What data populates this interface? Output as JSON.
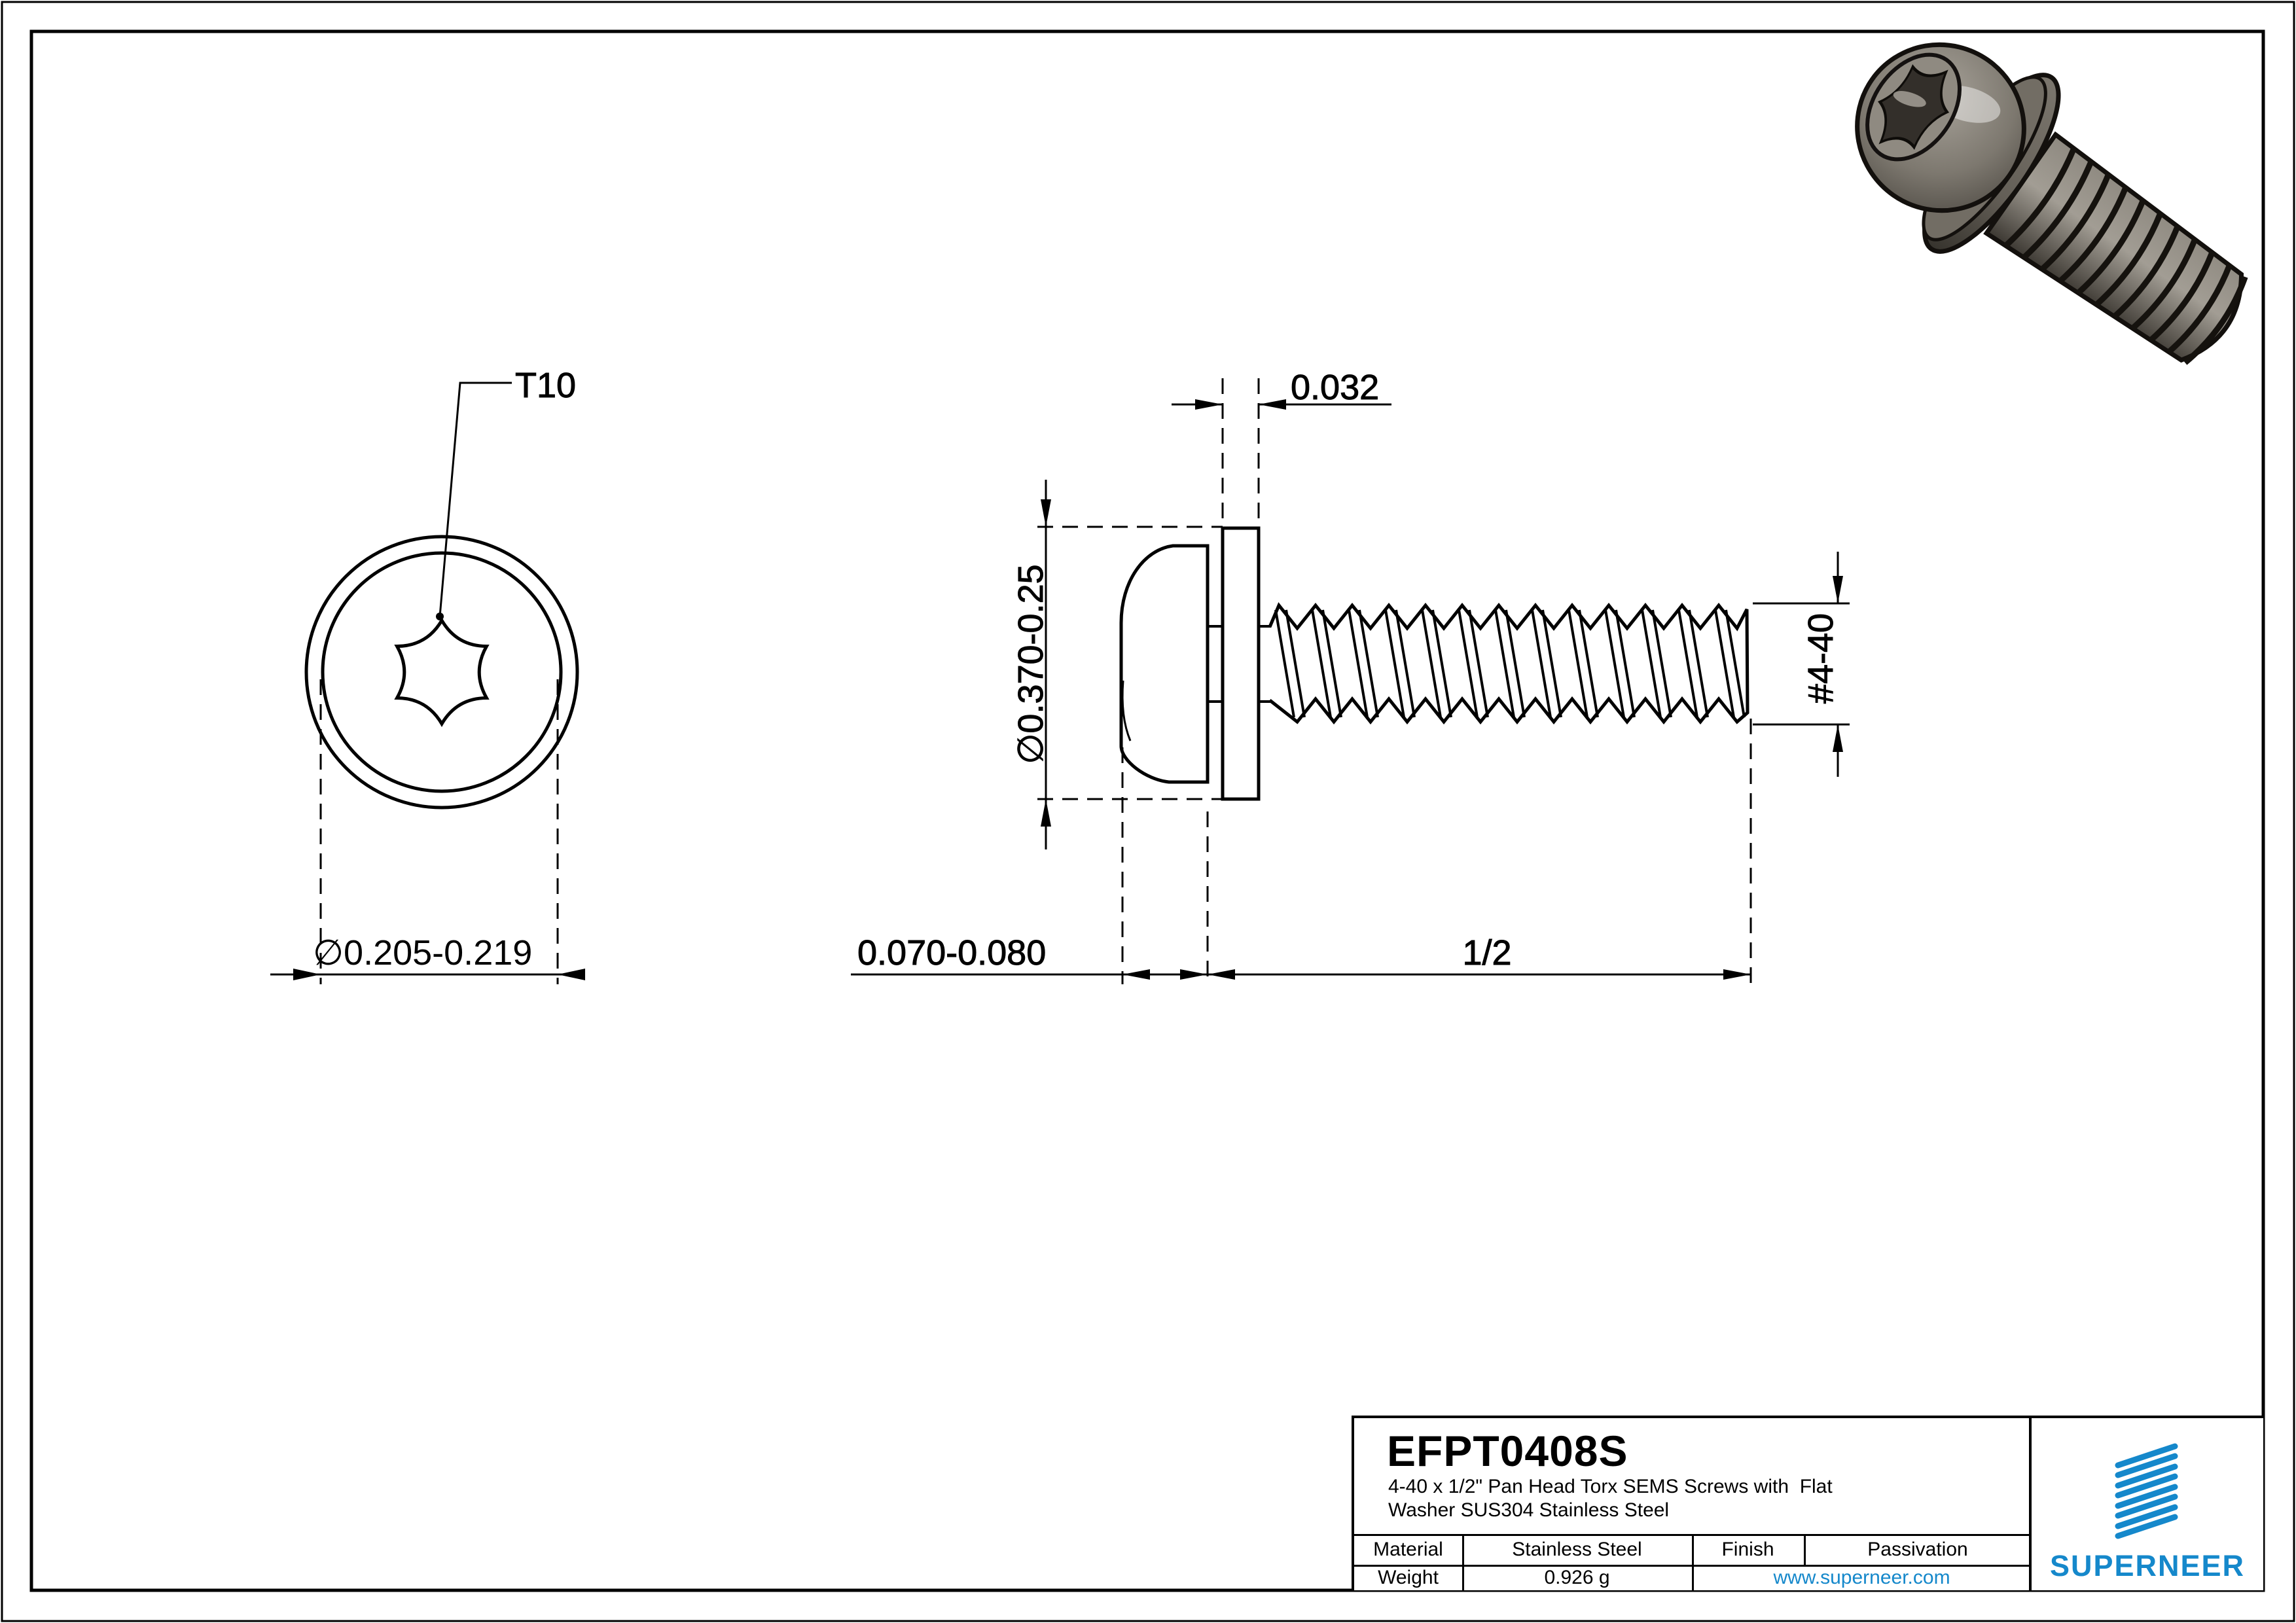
{
  "page": {
    "background": "#ffffff",
    "line_color": "#000000",
    "accent_blue": "#1588CB",
    "render_metal_light": "#9a958c",
    "render_metal_dark": "#45413b"
  },
  "views": {
    "top_view": {
      "torx_label": "T10",
      "head_diameter_label": "∅0.205-0.219"
    },
    "side_view": {
      "washer_thickness_label": "0.032",
      "washer_od_label": "∅0.370-0.25",
      "thread_size_label": "#4-40",
      "head_height_label": "0.070-0.080",
      "length_label": "1/2"
    }
  },
  "title_block": {
    "part_number": "EFPT0408S",
    "description_line1": "4-40 x 1/2\" Pan Head Torx SEMS Screws with  Flat",
    "description_line2": "Washer SUS304 Stainless Steel",
    "material_label": "Material",
    "material_value": "Stainless Steel",
    "finish_label": "Finish",
    "finish_value": "Passivation",
    "weight_label": "Weight",
    "weight_value": "0.926 g",
    "website": "www.superneer.com",
    "brand": "SUPERNEER"
  }
}
